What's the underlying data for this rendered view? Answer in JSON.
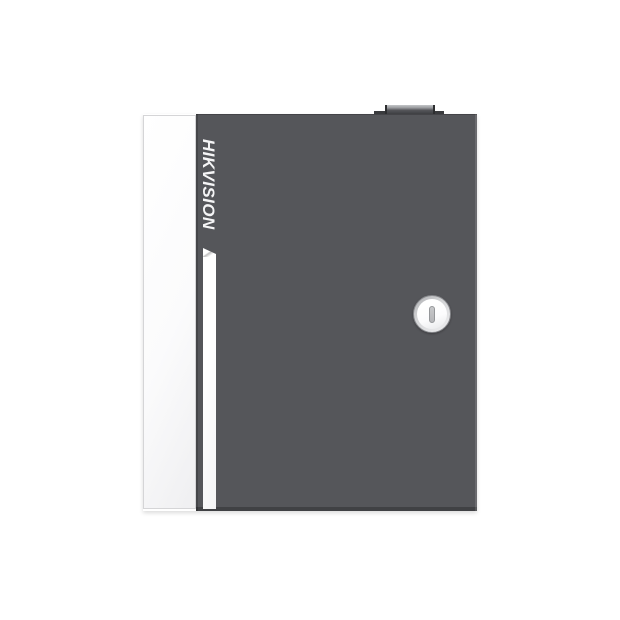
{
  "device": {
    "brand": "HIKVISION"
  },
  "colors": {
    "background": "#FFFFFF",
    "door": "#55565A",
    "panel": "#FBFBFC",
    "panel-border": "#D5D5D7",
    "stripe": "#F4F4F5",
    "logo": "#F5F5F6",
    "latch-base": "#3A3B3E",
    "latch-cap": "#3E3F42",
    "latch-cap-top": "#C4C6C8",
    "lock-ring": "#D3D4D6",
    "lock-ring-border": "#85868A",
    "lock-face": "#FCFCFD",
    "keyhole": "#C7C8CA",
    "keyhole-border": "#95979A"
  }
}
